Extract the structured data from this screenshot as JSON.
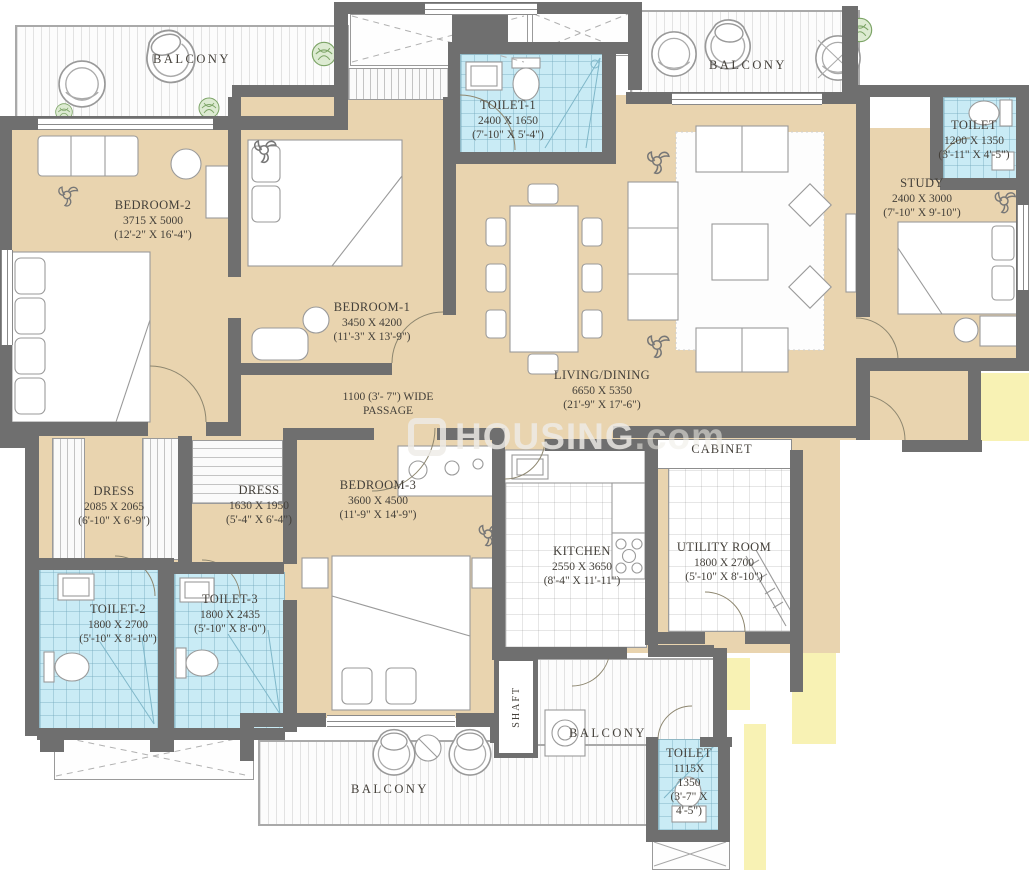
{
  "watermark": {
    "text_bold": "HOUSING",
    "text_tail": ".com"
  },
  "colors": {
    "floor_beige": "#e9d4af",
    "wall_gray": "#6f6f6f",
    "wet_area_blue": "#c9ebf5",
    "exterior_yellow": "#f8f2b4",
    "label_text": "#44403a"
  },
  "rooms": {
    "balcony_tl": {
      "name": "BALCONY"
    },
    "balcony_tr": {
      "name": "BALCONY"
    },
    "balcony_bottom": {
      "name": "BALCONY"
    },
    "balcony_bm": {
      "name": "BALCONY"
    },
    "bedroom2": {
      "name": "BEDROOM-2",
      "mm": "3715 X 5000",
      "ft": "(12'-2\" X 16'-4\")"
    },
    "bedroom1": {
      "name": "BEDROOM-1",
      "mm": "3450 X 4200",
      "ft": "(11'-3\" X 13'-9\")"
    },
    "bedroom3": {
      "name": "BEDROOM-3",
      "mm": "3600 X 4500",
      "ft": "(11'-9\" X 14'-9\")"
    },
    "toilet1": {
      "name": "TOILET-1",
      "mm": "2400 X 1650",
      "ft": "(7'-10\" X 5'-4\")"
    },
    "toilet2": {
      "name": "TOILET-2",
      "mm": "1800 X 2700",
      "ft": "(5'-10\" X 8'-10\")"
    },
    "toilet3": {
      "name": "TOILET-3",
      "mm": "1800 X 2435",
      "ft": "(5'-10\" X 8'-0\")"
    },
    "toilet_tr": {
      "name": "TOILET",
      "mm": "1200 X 1350",
      "ft": "(3'-11\" X 4'-5\")"
    },
    "toilet_b": {
      "name": "TOILET",
      "l1": "1115X",
      "l2": "1350",
      "l3": "(3'-7\" X",
      "l4": "4'-5\")"
    },
    "study": {
      "name": "STUDY",
      "mm": "2400 X 3000",
      "ft": "(7'-10\" X 9'-10\")"
    },
    "living": {
      "name": "LIVING/DINING",
      "mm": "6650 X 5350",
      "ft": "(21'-9\" X 17'-6\")"
    },
    "kitchen": {
      "name": "KITCHEN",
      "mm": "2550 X 3650",
      "ft": "(8'-4\" X 11'-11\")"
    },
    "utility": {
      "name": "UTILITY ROOM",
      "mm": "1800 X 2700",
      "ft": "(5'-10\" X 8'-10\")"
    },
    "dress1": {
      "name": "DRESS",
      "mm": "2085 X 2065",
      "ft": "(6'-10\" X 6'-9\")"
    },
    "dress2": {
      "name": "DRESS",
      "mm": "1630 X 1950",
      "ft": "(5'-4\" X 6'-4\")"
    },
    "passage": {
      "l1": "1100 (3'- 7\") WIDE",
      "l2": "PASSAGE"
    },
    "cabinet": {
      "name": "CABINET"
    },
    "shaft": {
      "name": "SHAFT"
    }
  }
}
